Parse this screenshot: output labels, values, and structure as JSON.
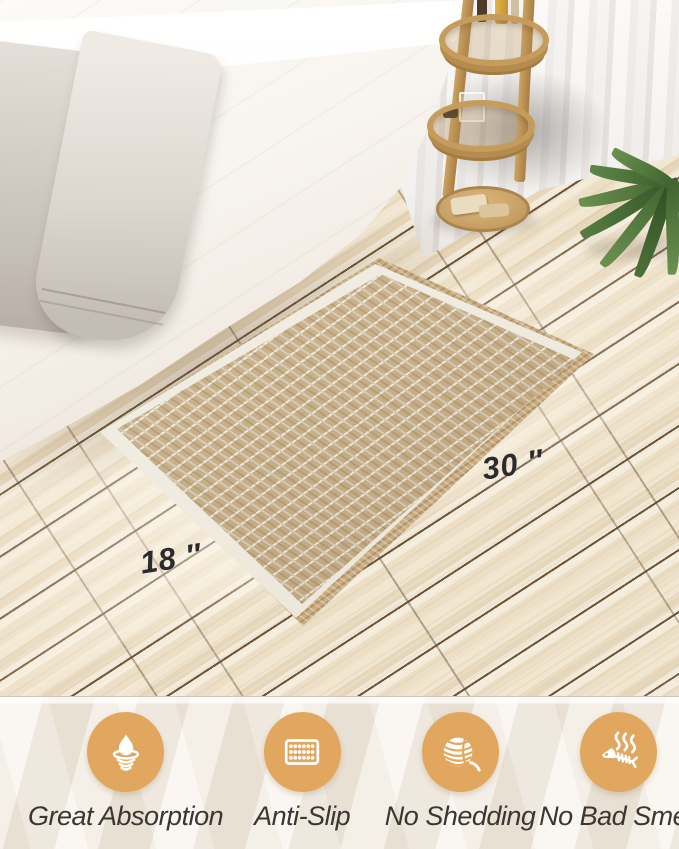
{
  "mat": {
    "width_label": "18 ″",
    "length_label": "30 ″"
  },
  "features": [
    {
      "icon": "absorption-drop-icon",
      "label": "Great Absorption"
    },
    {
      "icon": "anti-slip-dots-icon",
      "label": "Anti-Slip"
    },
    {
      "icon": "yarn-ball-icon",
      "label": "No Shedding"
    },
    {
      "icon": "fish-bone-icon",
      "label": "No Bad Smell"
    }
  ],
  "colors": {
    "accent_circle": "#e2a75e",
    "feature_text": "#3a3733",
    "dimension_text": "#2b2b2b"
  }
}
